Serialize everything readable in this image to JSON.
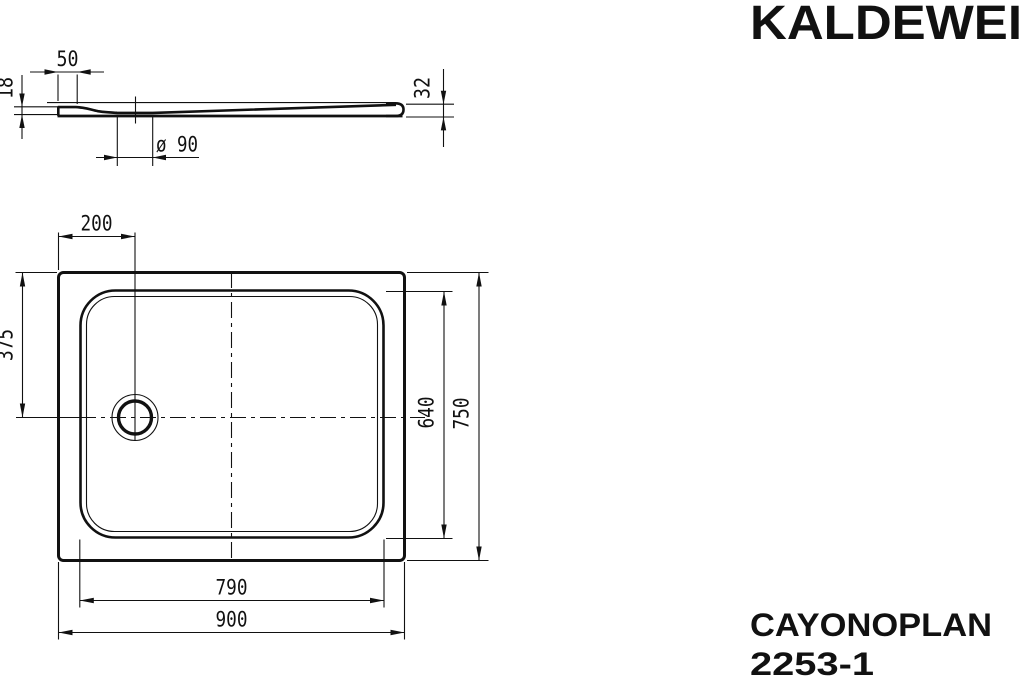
{
  "brand": {
    "name": "KALDEWEI"
  },
  "product": {
    "series": "CAYONOPLAN",
    "model": "2253-1"
  },
  "section_view": {
    "rim_width_mm": "50",
    "edge_height_mm": "18",
    "total_height_mm": "32",
    "drain_diameter": "ø 90"
  },
  "plan_view": {
    "drain_offset_from_left_mm": "200",
    "drain_offset_from_top_mm": "375",
    "inner_width_mm": "640",
    "outer_width_mm": "750",
    "inner_length_mm": "790",
    "outer_length_mm": "900"
  },
  "colors": {
    "line": "#111111",
    "background": "#ffffff"
  }
}
